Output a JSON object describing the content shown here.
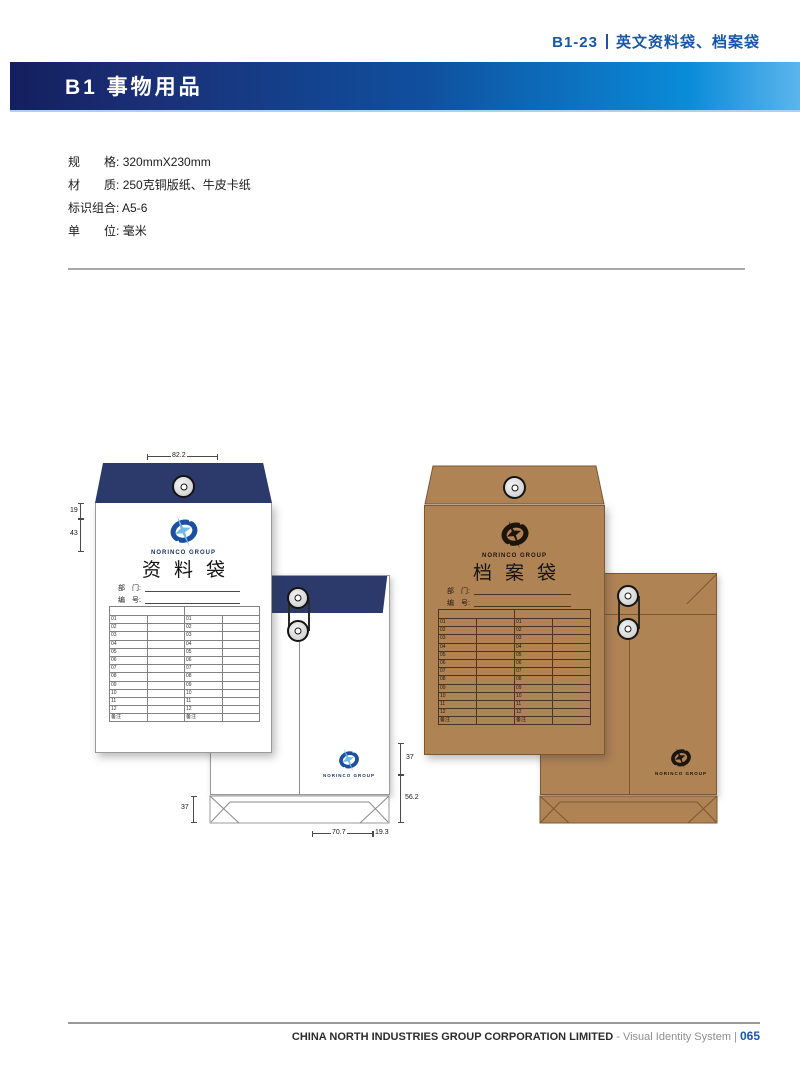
{
  "header": {
    "code": "B1-23",
    "title": "英文资料袋、档案袋"
  },
  "section_bar": {
    "title": "B1 事物用品"
  },
  "specs": {
    "rows": [
      {
        "label": "规　　格:",
        "value": "320mmX230mm"
      },
      {
        "label": "材　　质:",
        "value": "250克铜版纸、牛皮卡纸"
      },
      {
        "label": "标识组合:",
        "value": "A5-6"
      },
      {
        "label": "单　　位:",
        "value": "毫米"
      }
    ]
  },
  "white_envelope": {
    "brand": "NORINCO GROUP",
    "title": "资料袋",
    "field_labels": {
      "dept": "部　门:",
      "no": "编　号:"
    },
    "table_rows": [
      "01",
      "02",
      "03",
      "04",
      "05",
      "06",
      "07",
      "08",
      "09",
      "10",
      "11",
      "12",
      "备注"
    ],
    "dims": {
      "top_width": "82.2",
      "left_upper": "19",
      "left_lower": "43",
      "bottom_flap_left": "37",
      "right_upper": "37",
      "right_lower": "56.2",
      "bottom_inner": "70.7",
      "bottom_outer": "19.3"
    }
  },
  "kraft_envelope": {
    "brand": "NORINCO GROUP",
    "title": "档案袋",
    "field_labels": {
      "dept": "部　门:",
      "no": "编　号:"
    },
    "table_rows": [
      "01",
      "02",
      "03",
      "04",
      "05",
      "06",
      "07",
      "08",
      "09",
      "10",
      "11",
      "12",
      "备注"
    ]
  },
  "footer": {
    "company": "CHINA NORTH INDUSTRIES GROUP CORPORATION LIMITED",
    "dash": "-",
    "system": "Visual Identity System",
    "separator": "|",
    "page_number": "065"
  },
  "colors": {
    "navy_flap": "#2b3a6b",
    "kraft_paper": "#b08355",
    "accent_blue": "#1857a8",
    "bar_gradient_start": "#131f5e",
    "bar_gradient_end": "#5cb5ec",
    "logo_blue": "#1d4fa0",
    "logo_spark": "#6fb9e9"
  }
}
